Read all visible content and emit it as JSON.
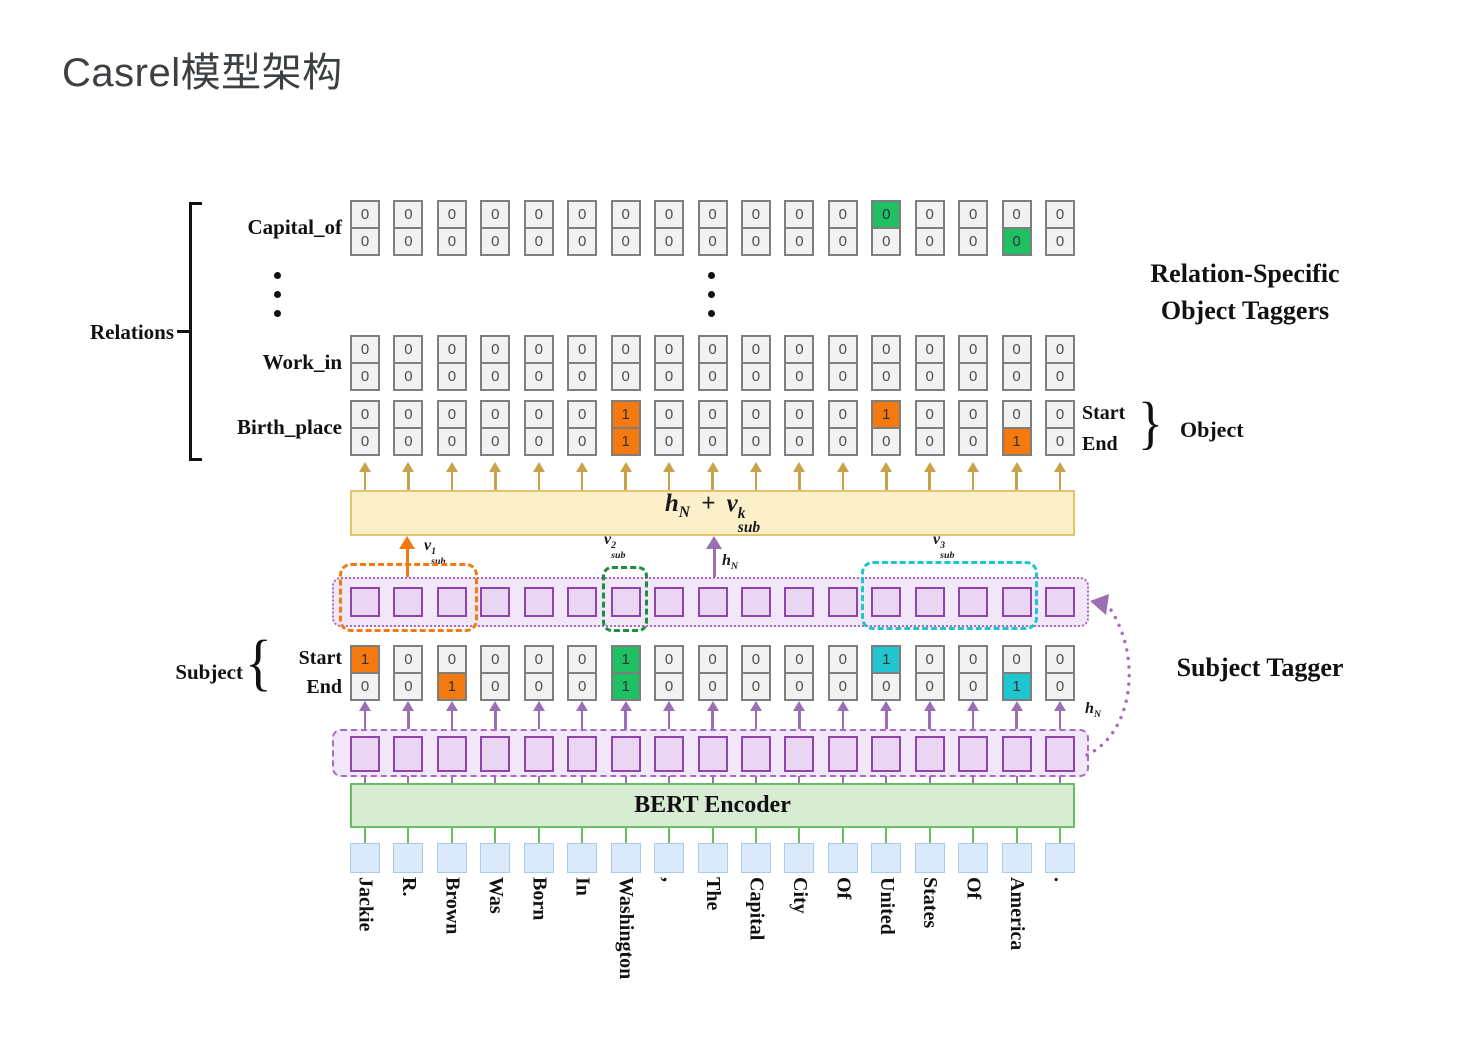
{
  "title": "Casrel模型架构",
  "labels": {
    "relations": "Relations",
    "relation_specific_1": "Relation-Specific",
    "relation_specific_2": "Object Taggers",
    "object_start": "Start",
    "object_end": "End",
    "object": "Object",
    "subject": "Subject",
    "subject_start": "Start",
    "subject_end": "End",
    "subject_tagger": "Subject Tagger",
    "bert": "BERT Encoder",
    "brace_right": "}",
    "brace_left": "{"
  },
  "math": {
    "h": "h",
    "N": "N",
    "plus": "+",
    "v": "v",
    "sub": "sub",
    "k": "k",
    "v1": "1",
    "v2": "2",
    "v3": "3"
  },
  "tokens": [
    "Jackie",
    "R.",
    "Brown",
    "Was",
    "Born",
    "In",
    "Washington",
    ",",
    "The",
    "Capital",
    "City",
    "Of",
    "United",
    "States",
    "Of",
    "America",
    "."
  ],
  "relations": {
    "rows": [
      {
        "label": "Capital_of",
        "start": [
          "0",
          "0",
          "0",
          "0",
          "0",
          "0",
          "0",
          "0",
          "0",
          "0",
          "0",
          "0",
          "0",
          "0",
          "0",
          "0",
          "0"
        ],
        "end": [
          "0",
          "0",
          "0",
          "0",
          "0",
          "0",
          "0",
          "0",
          "0",
          "0",
          "0",
          "0",
          "0",
          "0",
          "0",
          "0",
          "0"
        ],
        "start_hl": {
          "12": "green"
        },
        "end_hl": {
          "15": "green"
        }
      },
      {
        "label": "Work_in",
        "start": [
          "0",
          "0",
          "0",
          "0",
          "0",
          "0",
          "0",
          "0",
          "0",
          "0",
          "0",
          "0",
          "0",
          "0",
          "0",
          "0",
          "0"
        ],
        "end": [
          "0",
          "0",
          "0",
          "0",
          "0",
          "0",
          "0",
          "0",
          "0",
          "0",
          "0",
          "0",
          "0",
          "0",
          "0",
          "0",
          "0"
        ],
        "start_hl": {},
        "end_hl": {}
      },
      {
        "label": "Birth_place",
        "start": [
          "0",
          "0",
          "0",
          "0",
          "0",
          "0",
          "1",
          "0",
          "0",
          "0",
          "0",
          "0",
          "1",
          "0",
          "0",
          "0",
          "0"
        ],
        "end": [
          "0",
          "0",
          "0",
          "0",
          "0",
          "0",
          "1",
          "0",
          "0",
          "0",
          "0",
          "0",
          "0",
          "0",
          "0",
          "1",
          "0"
        ],
        "start_hl": {
          "6": "orange",
          "12": "orange"
        },
        "end_hl": {
          "6": "orange",
          "15": "orange"
        }
      }
    ]
  },
  "subject": {
    "start": [
      "1",
      "0",
      "0",
      "0",
      "0",
      "0",
      "1",
      "0",
      "0",
      "0",
      "0",
      "0",
      "1",
      "0",
      "0",
      "0",
      "0"
    ],
    "end": [
      "0",
      "0",
      "1",
      "0",
      "0",
      "0",
      "1",
      "0",
      "0",
      "0",
      "0",
      "0",
      "0",
      "0",
      "0",
      "1",
      "0"
    ],
    "start_hl": {
      "0": "orange",
      "6": "green",
      "12": "cyan"
    },
    "end_hl": {
      "2": "orange",
      "6": "green",
      "15": "cyan"
    }
  },
  "colors": {
    "orange": "#F4790E",
    "green": "#1FBF63",
    "cyan": "#1FC5CF",
    "green_dash": "#1E8E3E",
    "purple": "#8E44AD",
    "purple_light": "#A66BBE",
    "purple_arrow": "#9B6FB3",
    "tan": "#C8A24B",
    "yellow_fill": "#FCF0CA",
    "yellow_border": "#E2C46F",
    "bert_fill": "#D7ECD2",
    "bert_border": "#68BE66",
    "blue_fill": "#DAEAFB",
    "blue_border": "#A8CBEE",
    "cell_fill": "#F2F2F2",
    "cell_border": "#7E7E7E",
    "lavender": "#F2E7F8",
    "square_fill": "#EAD6F2"
  }
}
